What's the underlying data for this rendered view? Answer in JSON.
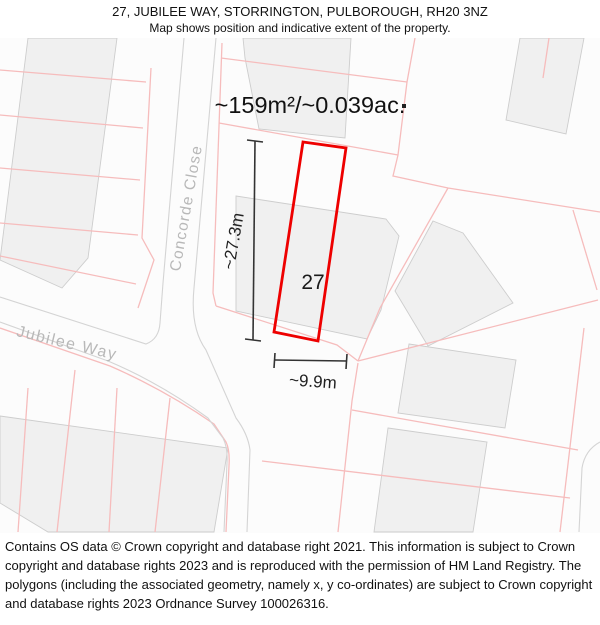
{
  "header": {
    "title": "27, JUBILEE WAY, STORRINGTON, PULBOROUGH, RH20 3NZ",
    "subtitle": "Map shows position and indicative extent of the property."
  },
  "map": {
    "area_label": "~159m²/~0.039ac.",
    "plot_number": "27",
    "height_label": "~27.3m",
    "width_label": "~9.9m",
    "streets": {
      "concorde_close": "Concorde Close",
      "jubilee_way": "Jubilee Way"
    },
    "colors": {
      "plot_outline": "#ee0000",
      "parcel_line": "#f6bcbc",
      "building_fill": "#f0f0f0",
      "building_stroke": "#cdcdcd",
      "road_line": "#d4d4d4",
      "street_label": "#b8b8b8",
      "dimension": "#333333"
    }
  },
  "footer": {
    "attribution": "Contains OS data © Crown copyright and database right 2021. This information is subject to Crown copyright and database rights 2023 and is reproduced with the permission of HM Land Registry. The polygons (including the associated geometry, namely x, y co-ordinates) are subject to Crown copyright and database rights 2023 Ordnance Survey 100026316."
  }
}
